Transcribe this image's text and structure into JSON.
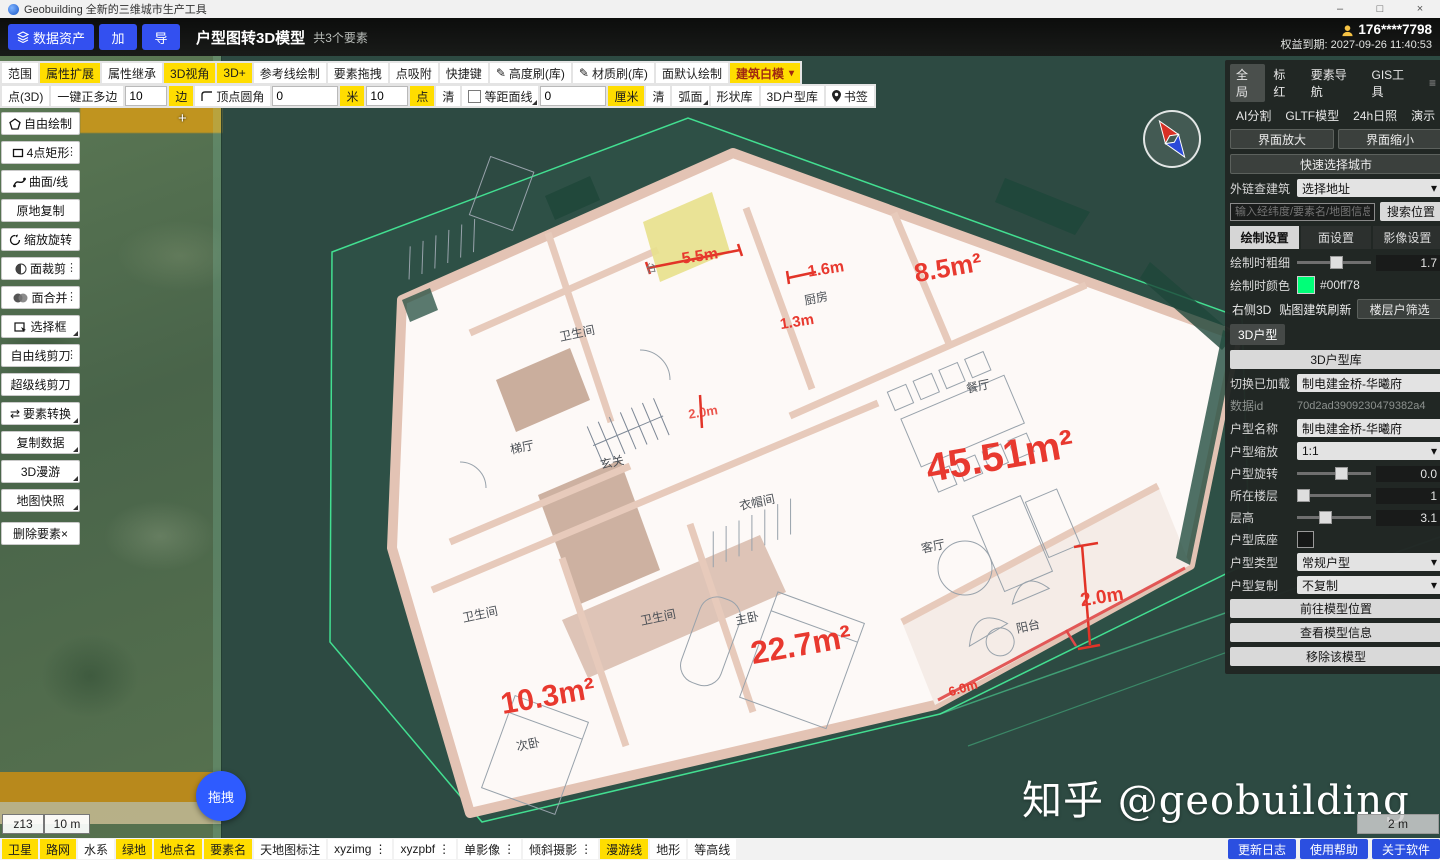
{
  "titlebar": {
    "app_title": "Geobuilding 全新的三维城市生产工具",
    "min": "–",
    "max": "□",
    "close": "×"
  },
  "header": {
    "data_asset": "数据资产",
    "btn_add": "加",
    "btn_export": "导",
    "title": "户型图转3D模型",
    "subtitle": "共3个要素",
    "user_phone": "176****7798",
    "expiry": "权益到期: 2027-09-26 11:40:53"
  },
  "toolbar_top": {
    "items": [
      {
        "label": "范围"
      },
      {
        "label": "属性扩展"
      },
      {
        "label": "属性继承"
      },
      {
        "label": "3D视角"
      },
      {
        "label": "3D+"
      },
      {
        "label": "参考线绘制"
      },
      {
        "label": "要素拖拽"
      },
      {
        "label": "点吸附"
      },
      {
        "label": "快捷键"
      },
      {
        "label": "高度刷(库)"
      },
      {
        "label": "材质刷(库)"
      },
      {
        "label": "面默认绘制"
      },
      {
        "label": "建筑白模"
      }
    ]
  },
  "toolbar_draw": {
    "point3d": "点(3D)",
    "polygon_one_key": "一键正多边",
    "sides_value": "10",
    "sides_unit": "边",
    "corner_round": "顶点圆角",
    "corner_value": "0",
    "corner_unit": "米",
    "pts_value": "10",
    "pts_unit": "点",
    "clear1": "清",
    "equidistant": "等距面线",
    "equi_value": "0",
    "equi_unit": "厘米",
    "clear2": "清",
    "arc": "弧面",
    "shape_lib": "形状库",
    "house_lib": "3D户型库",
    "bookmark": "书签"
  },
  "left_tools": {
    "items": [
      {
        "label": "自由绘制"
      },
      {
        "label": "4点矩形"
      },
      {
        "label": "曲面/线"
      },
      {
        "label": "原地复制"
      },
      {
        "label": "缩放旋转"
      },
      {
        "label": "面裁剪"
      },
      {
        "label": "面合并"
      },
      {
        "label": "选择框"
      },
      {
        "label": "自由线剪刀"
      },
      {
        "label": "超级线剪刀"
      },
      {
        "label": "要素转换"
      },
      {
        "label": "复制数据"
      },
      {
        "label": "3D漫游"
      },
      {
        "label": "地图快照"
      }
    ],
    "delete_label": "删除要素×"
  },
  "right_panel": {
    "tabs1": [
      "全局",
      "标红",
      "要素导航",
      "GIS工具"
    ],
    "tabs2": [
      "AI分割",
      "GLTF模型",
      "24h日照",
      "演示"
    ],
    "zoom_in": "界面放大",
    "zoom_out": "界面缩小",
    "quick_city": "快速选择城市",
    "ext_label": "外链查建筑",
    "ext_value": "选择地址",
    "search_placeholder": "输入经纬度/要素名/地图信息",
    "search_btn": "搜索位置",
    "tabs3": [
      "绘制设置",
      "面设置",
      "影像设置"
    ],
    "stroke_label": "绘制时粗细",
    "stroke_value": "1.7",
    "color_label": "绘制时颜色",
    "color_value": "#00ff78",
    "btn_right3d": "右侧3D",
    "btn_refresh": "贴图建筑刷新",
    "btn_floor_filter": "楼层户筛选",
    "chip_3dht": "3D户型",
    "btn_lib": "3D户型库",
    "switch_label": "切换已加载",
    "switch_value": "制电建金桥-华曦府",
    "dataid_label": "数据id",
    "dataid_value": "70d2ad3909230479382a4",
    "name_label": "户型名称",
    "name_value": "制电建金桥-华曦府",
    "scale_label": "户型缩放",
    "scale_value": "1:1",
    "rotate_label": "户型旋转",
    "rotate_value": "0.0",
    "floor_label": "所在楼层",
    "floor_value": "1",
    "height_label": "层高",
    "height_value": "3.1",
    "base_label": "户型底座",
    "type_label": "户型类型",
    "type_value": "常规户型",
    "copy_label": "户型复制",
    "copy_value": "不复制",
    "goto_btn": "前往模型位置",
    "info_btn": "查看模型信息",
    "remove_btn": "移除该模型"
  },
  "viewport": {
    "watermark": "知乎 @geobuilding",
    "zoom_level": "z13",
    "scale_left": "10 m",
    "scale_right": "2 m",
    "drag_label": "拖拽"
  },
  "floorplan": {
    "rooms": [
      {
        "label": "卫生间"
      },
      {
        "label": "厨房"
      },
      {
        "label": "梯厅"
      },
      {
        "label": "玄关"
      },
      {
        "label": "餐厅"
      },
      {
        "label": "衣帽间"
      },
      {
        "label": "客厅"
      },
      {
        "label": "卫生间"
      },
      {
        "label": "卫生间"
      },
      {
        "label": "主卧"
      },
      {
        "label": "阳台"
      },
      {
        "label": "次卧"
      },
      {
        "label": "台"
      }
    ],
    "areas": [
      {
        "label": "8.5m²"
      },
      {
        "label": "45.51m²"
      },
      {
        "label": "22.7m²"
      },
      {
        "label": "10.3m²"
      }
    ],
    "dims": [
      {
        "label": "5.5m"
      },
      {
        "label": "1.6m"
      },
      {
        "label": "1.3m"
      },
      {
        "label": "2.0m"
      },
      {
        "label": "2.0m"
      },
      {
        "label": "6.0m"
      }
    ]
  },
  "bottom_bar": {
    "layers": [
      {
        "label": "卫星"
      },
      {
        "label": "路网"
      },
      {
        "label": "水系"
      },
      {
        "label": "绿地"
      },
      {
        "label": "地点名"
      },
      {
        "label": "要素名"
      },
      {
        "label": "天地图标注"
      },
      {
        "label": "xyzimg"
      },
      {
        "label": "xyzpbf"
      },
      {
        "label": "单影像"
      },
      {
        "label": "倾斜摄影"
      },
      {
        "label": "漫游线"
      },
      {
        "label": "地形"
      },
      {
        "label": "等高线"
      }
    ],
    "actions": [
      {
        "label": "更新日志"
      },
      {
        "label": "使用帮助"
      },
      {
        "label": "关于软件"
      }
    ]
  }
}
